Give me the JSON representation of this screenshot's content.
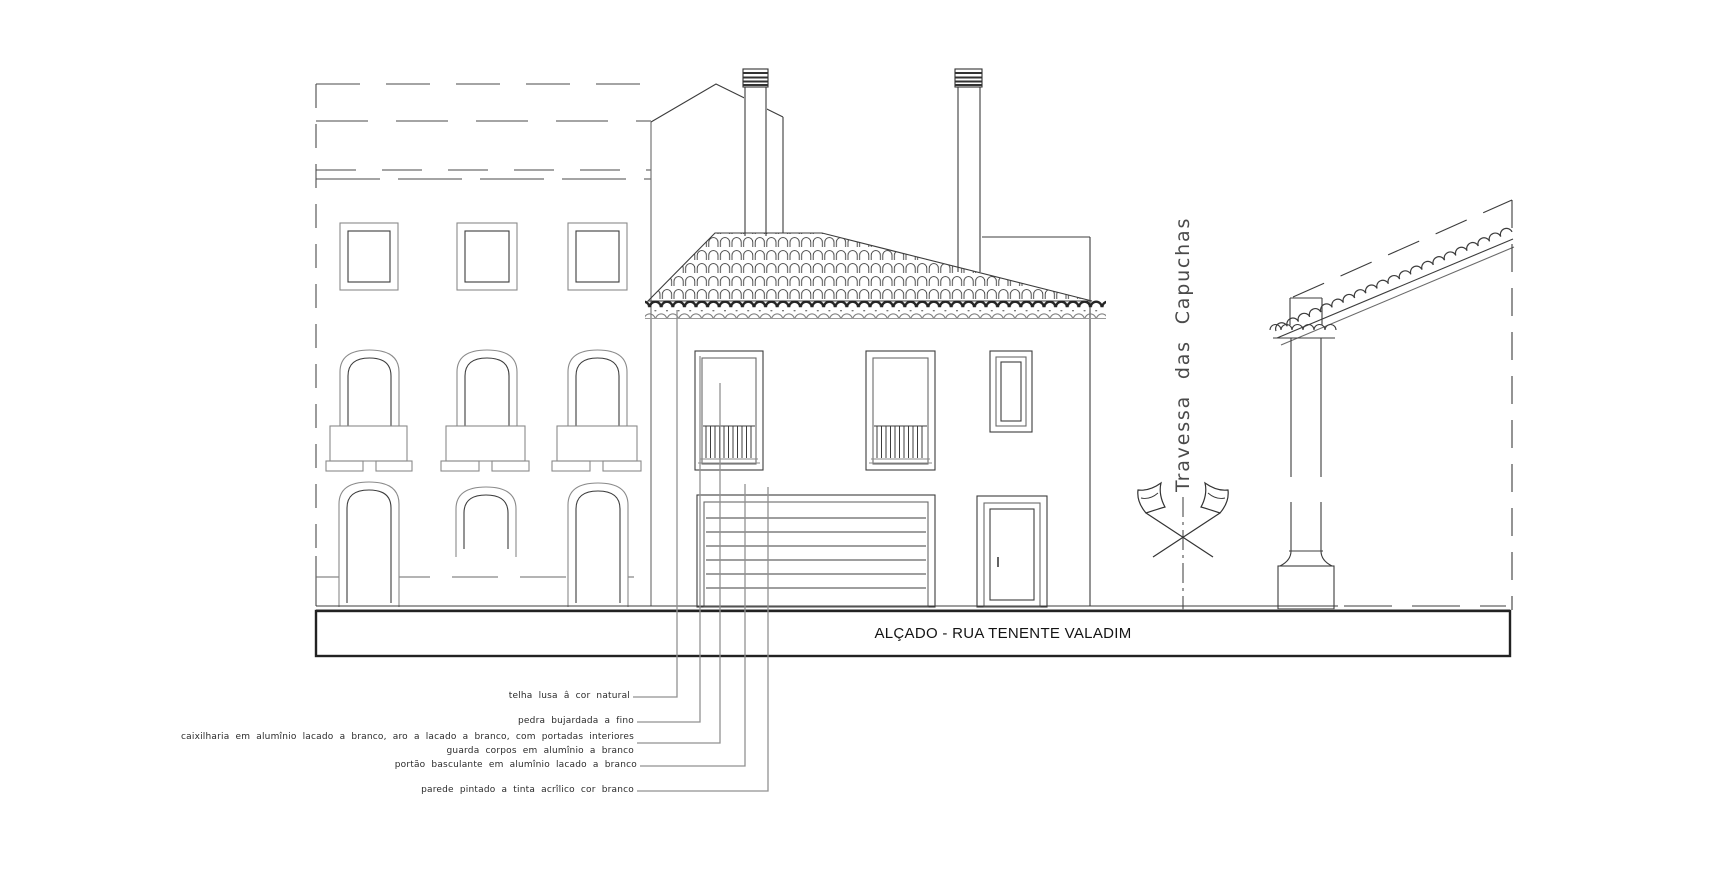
{
  "document": {
    "title": "ALÇADO - RUA TENENTE VALADIM",
    "street_label": "Travessa das Capuchas"
  },
  "annotations": {
    "items": [
      {
        "label": "telha lusa â cor natural"
      },
      {
        "label": "pedra bujardada a fino"
      },
      {
        "label": "caixilharia em alumînio lacado a branco, aro a lacado a branco, com portadas interiores"
      },
      {
        "label": "guarda corpos em alumînio a branco"
      },
      {
        "label": "portão basculante em alumînio lacado a branco"
      },
      {
        "label": "parede pintado a tinta acrîlico cor branco"
      }
    ]
  },
  "colors": {
    "background": "#ffffff",
    "line": "#3c3c3c",
    "light_line": "#8a8a8a",
    "leader": "#919191",
    "band_border": "#222222"
  }
}
